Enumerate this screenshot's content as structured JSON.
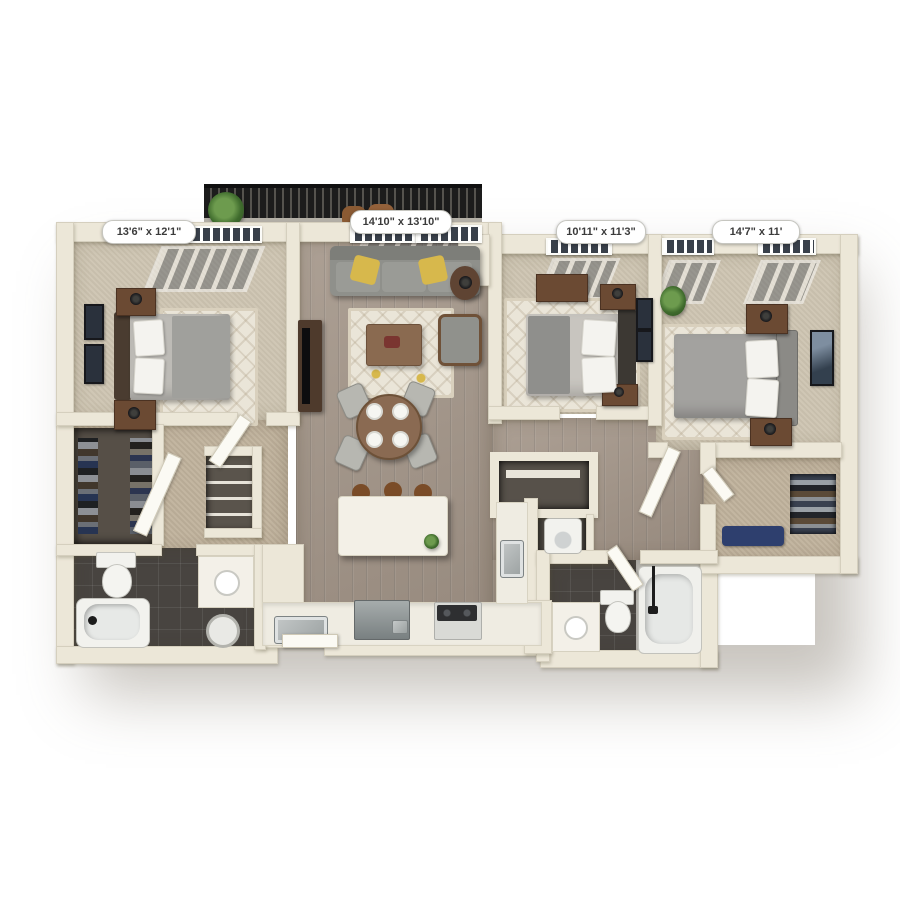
{
  "floorplan": {
    "title": "3 bedroom apartment 3D floor plan",
    "rooms": [
      {
        "name": "bedroom-left",
        "dimensions": "13'6\" x 12'1\""
      },
      {
        "name": "living-room",
        "dimensions": "14'10\" x 13'10\""
      },
      {
        "name": "bedroom-middle",
        "dimensions": "10'11\" x 11'3\""
      },
      {
        "name": "bedroom-right",
        "dimensions": "14'7\" x 11'"
      }
    ],
    "colors": {
      "background": "#ffffff",
      "wall": "#ece7d8",
      "carpet": "#cdc4b1",
      "carpet_hall": "#c0b29c",
      "wood_floor": "#a39588",
      "tile_dark": "#484440",
      "tile_light": "#c7c6c1",
      "rug": "#eae5d8",
      "sofa_gray": "#8f908b",
      "pillow_yellow": "#d7b84c",
      "furniture_brown": "#6b4a33",
      "railing_black": "#1c1c1c",
      "appliance_steel": "#a7abac",
      "label_text": "#3b3b3b"
    }
  }
}
